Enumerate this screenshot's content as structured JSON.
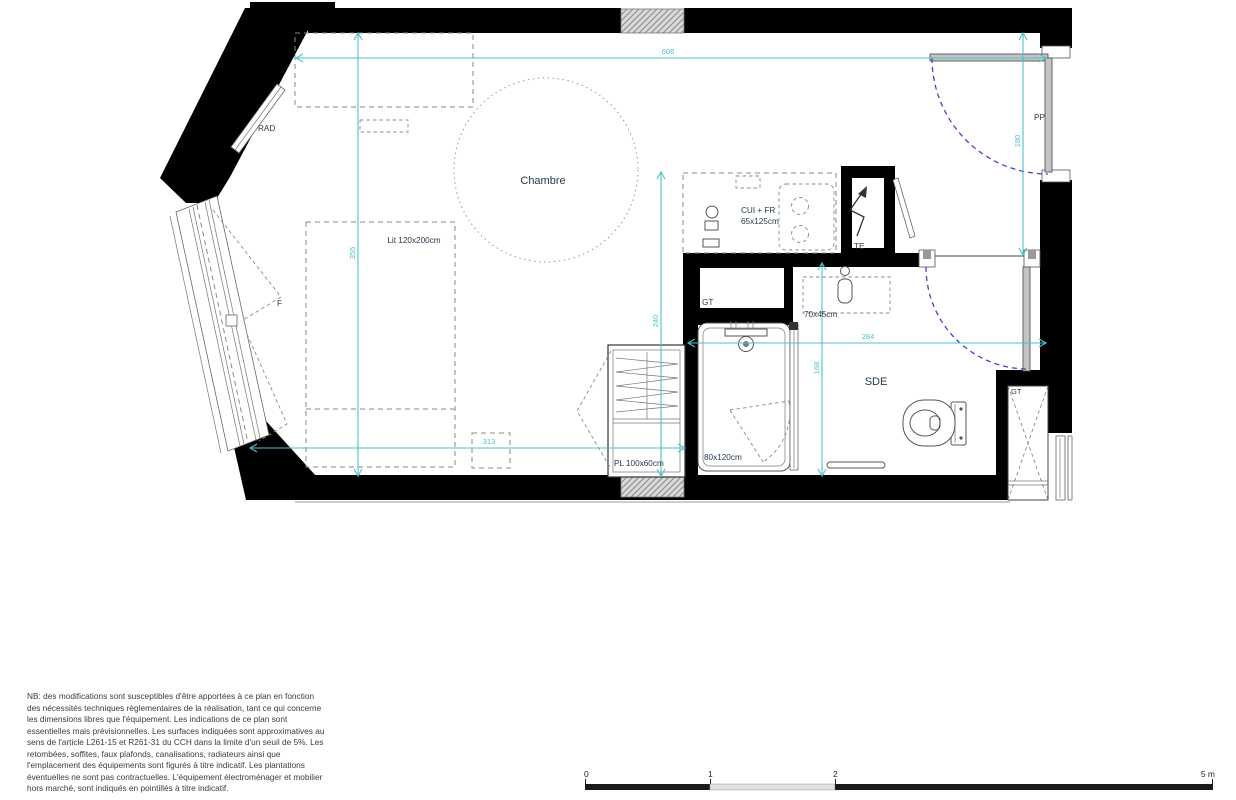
{
  "plan": {
    "room_labels": {
      "chambre": "Chambre",
      "sde": "SDE"
    },
    "labels": {
      "rad": "RAD",
      "window": "F",
      "bed": "Lit 120x200cm",
      "kitchen_line1": "CUI + FR",
      "kitchen_line2": "65x125cm",
      "te": "TE",
      "gt_kitchen": "GT",
      "gt_corner": "GT",
      "basin": "70x45cm",
      "shower": "80x120cm",
      "closet": "PL 100x60cm",
      "entry_door": "PP"
    },
    "dimensions_cm": {
      "top_width": "606",
      "room_height": "355",
      "room_depth": "240",
      "bed_clearance": "313",
      "sde_width": "284",
      "sde_depth": "168",
      "entry_depth": "180"
    },
    "colors": {
      "wall": "#000000",
      "dimension_line": "#4ec1cc",
      "door_swing": "#3d46c9",
      "label_text": "#27394e",
      "hatch_fill": "#d9d9d9"
    }
  },
  "scale_bar": {
    "labels": [
      "0",
      "1",
      "2",
      "5 m"
    ]
  },
  "disclaimer": {
    "lines": [
      "NB: des modifications sont susceptibles d'être apportées à ce plan en fonction",
      "des nécessités techniques règlementaires de la réalisation, tant ce qui concerne",
      "les dimensions libres que l'équipement. Les indications de ce plan sont",
      "essentielles mais prévisionnelles. Les surfaces indiquées sont approximatives au",
      "sens de l'article L261-15 et R261-31 du CCH dans la limite d'un seuil de 5%. Les",
      "retombées, soffites, faux plafonds, canalisations, radiateurs ainsi que",
      "l'emplacement des équipements sont figurés à titre indicatif. Les plantations",
      "éventuelles ne sont pas contractuelles. L'équipement électroménager et mobilier",
      "hors marché,  sont indiqués en pointillés à titre indicatif."
    ]
  }
}
